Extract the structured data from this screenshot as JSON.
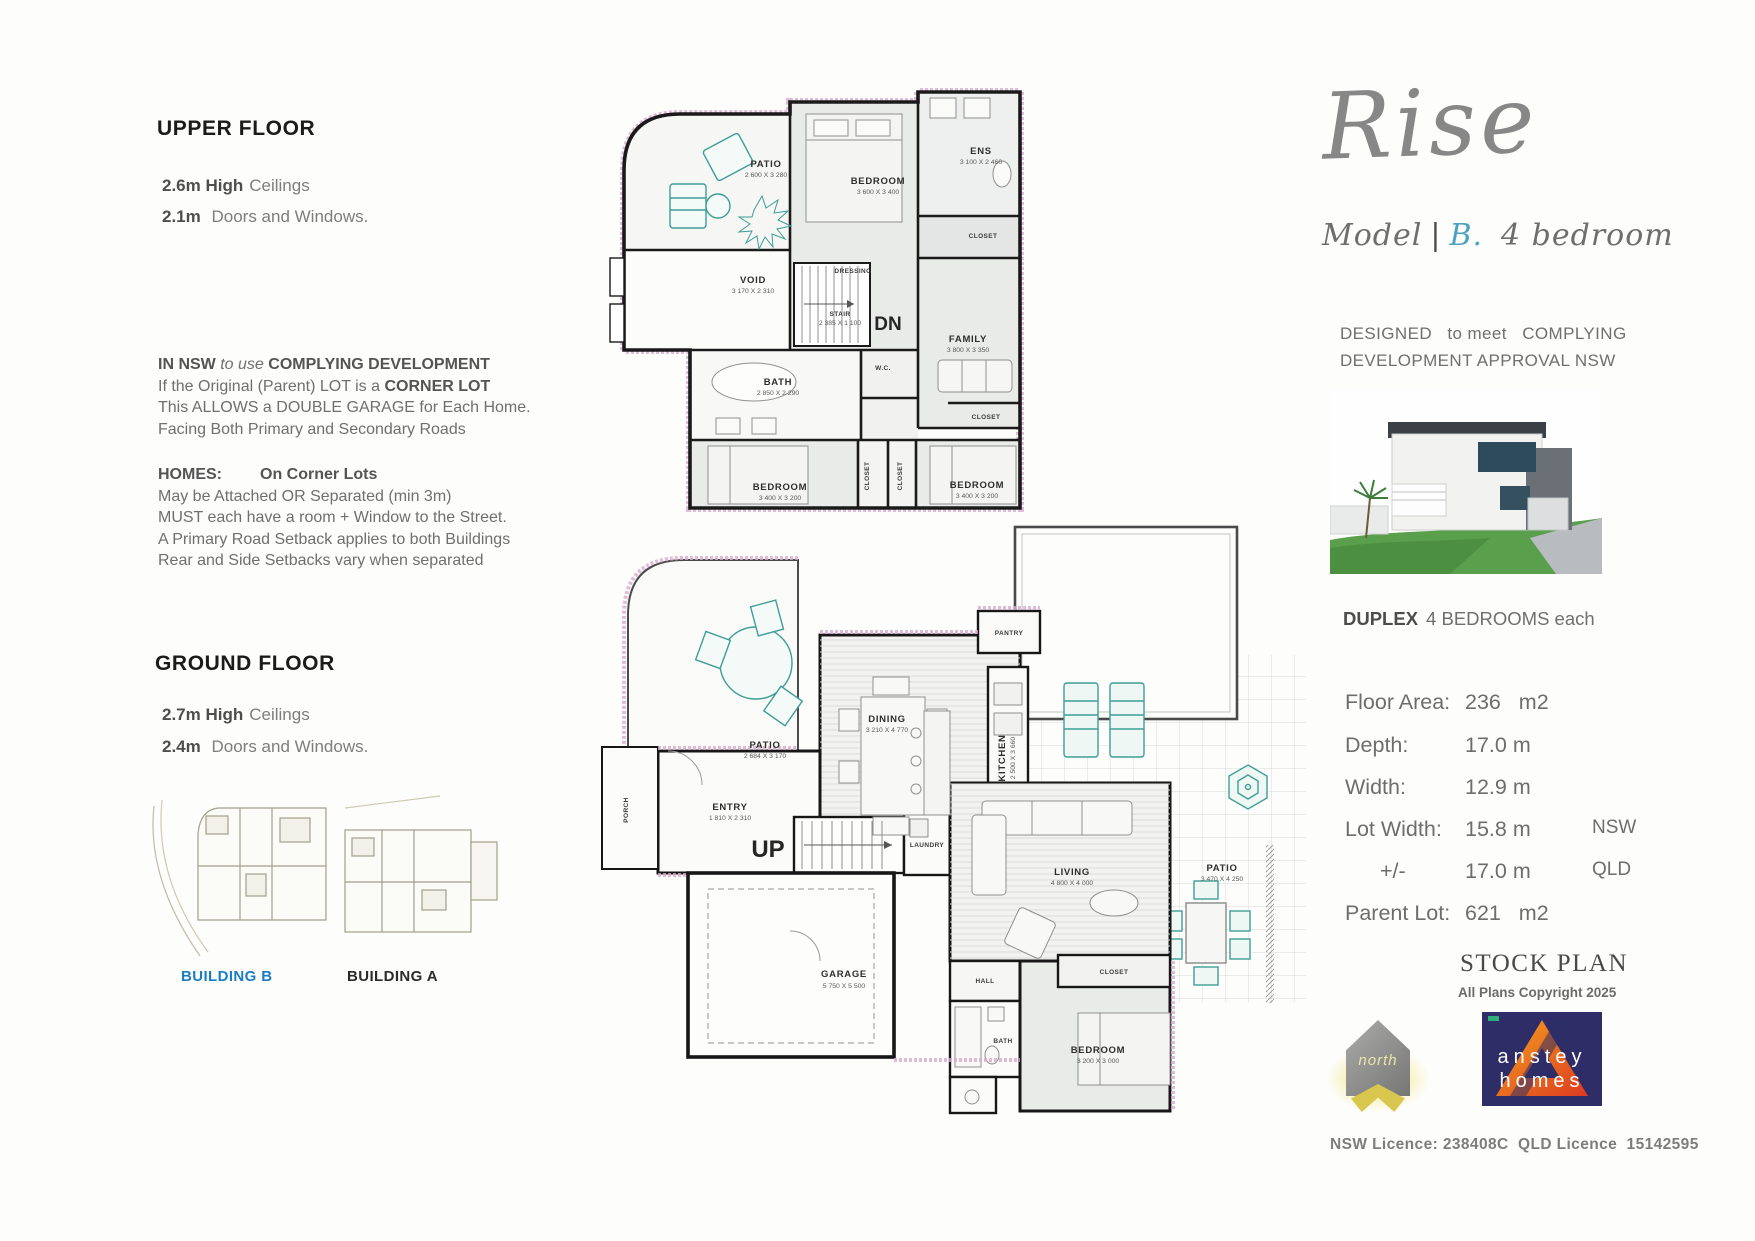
{
  "colors": {
    "building_b_blue": "#1b7dc2",
    "variant_teal": "#4da3bf",
    "plan_accent_pink": "#d9abce",
    "furniture_teal": "#3f9d96",
    "anstey_navy": "#2e2d68",
    "anstey_orange": "#f5a21f",
    "north_gold": "#d9c64e"
  },
  "left_column": {
    "upper_floor": {
      "heading": "UPPER FLOOR",
      "lines": [
        {
          "bold": "2.6m High",
          "rest": "Ceilings"
        },
        {
          "bold": "2.1m",
          "rest": " Doors and Windows."
        }
      ]
    },
    "nsw_note": {
      "l1a": "IN NSW",
      "l1b": " to use ",
      "l1c": "COMPLYING DEVELOPMENT",
      "l2a": "If the Original (Parent) LOT is a ",
      "l2b": "CORNER LOT",
      "l3": "This ALLOWS a DOUBLE GARAGE for Each Home.",
      "l4": "Facing Both Primary and Secondary Roads"
    },
    "homes_note": {
      "h1a": "HOMES:",
      "h1b": "On Corner Lots",
      "h2": "May be Attached OR Separated (min 3m)",
      "h3": "MUST each have a room + Window to the Street.",
      "h4": "A Primary Road Setback applies to both Buildings",
      "h5": "Rear and Side Setbacks vary when separated"
    },
    "ground_floor": {
      "heading": "GROUND FLOOR",
      "lines": [
        {
          "bold": "2.7m High",
          "rest": "Ceilings"
        },
        {
          "bold": "2.4m",
          "rest": " Doors and Windows."
        }
      ]
    },
    "site_plan": {
      "building_b": "BUILDING B",
      "building_a": "BUILDING A"
    }
  },
  "upper_plan": {
    "rooms": {
      "patio": {
        "name": "PATIO",
        "dims": "2 600 X 3 280"
      },
      "bedroom_master": {
        "name": "BEDROOM",
        "dims": "3 600 X 3 400"
      },
      "ens": {
        "name": "ENS",
        "dims": "3 100 X 2 460"
      },
      "closet_master": {
        "name": "CLOSET"
      },
      "dressing": {
        "name": "DRESSING"
      },
      "void": {
        "name": "VOID",
        "dims": "3 170 X 2 310"
      },
      "stair": {
        "name": "STAIR",
        "dims": "2 385 X 1 100",
        "direction": "DN"
      },
      "bath": {
        "name": "BATH",
        "dims": "2 850 X 2 290"
      },
      "wc": {
        "name": "W.C."
      },
      "family": {
        "name": "FAMILY",
        "dims": "3 800 X 3 350"
      },
      "closet_hall": {
        "name": "CLOSET"
      },
      "bedroom_left": {
        "name": "BEDROOM",
        "dims": "3 400 X 3 200"
      },
      "bedroom_right": {
        "name": "BEDROOM",
        "dims": "3 400 X 3 200"
      },
      "closet_mid_a": {
        "name": "CLOSET"
      },
      "closet_mid_b": {
        "name": "CLOSET"
      }
    }
  },
  "ground_plan": {
    "rooms": {
      "patio_front": {
        "name": "PATIO",
        "dims": "2 684 X 3 170"
      },
      "dining": {
        "name": "DINING",
        "dims": "3 210 X 4 770"
      },
      "pantry": {
        "name": "PANTRY"
      },
      "kitchen": {
        "name": "KITCHEN",
        "dims": "2 500 X 3 660"
      },
      "entry": {
        "name": "ENTRY",
        "dims": "1 810 X 2 310"
      },
      "porch": {
        "name": "PORCH"
      },
      "stair": {
        "direction": "UP"
      },
      "laundry": {
        "name": "LAUNDRY"
      },
      "living": {
        "name": "LIVING",
        "dims": "4 800 X 4 000"
      },
      "patio_rear": {
        "name": "PATIO",
        "dims": "3 470 X 4 250"
      },
      "garage": {
        "name": "GARAGE",
        "dims": "5 750 X 5 500"
      },
      "hall": {
        "name": "HALL"
      },
      "bath": {
        "name": "BATH"
      },
      "closet": {
        "name": "CLOSET"
      },
      "bedroom": {
        "name": "BEDROOM",
        "dims": "3 200 X 3 000"
      }
    }
  },
  "right_column": {
    "brand": "Rise",
    "model": {
      "prefix": "Model",
      "bar": "|",
      "variant": "B.",
      "suffix": "4 bedroom"
    },
    "designed_line1": "DESIGNED   to meet   COMPLYING",
    "designed_line2": "DEVELOPMENT APPROVAL NSW",
    "duplex": {
      "bold": "DUPLEX",
      "rest": "4 BEDROOMS each"
    },
    "specs": [
      {
        "label": "Floor Area:",
        "value": "236   m2",
        "region": ""
      },
      {
        "label": "Depth:",
        "value": "17.0 m",
        "region": ""
      },
      {
        "label": "Width:",
        "value": "12.9 m",
        "region": ""
      },
      {
        "label": "Lot Width:",
        "value": "15.8 m",
        "region": "NSW"
      },
      {
        "label": "+/-",
        "value": "17.0 m",
        "region": "QLD"
      },
      {
        "label": "Parent Lot:",
        "value": "621   m2",
        "region": ""
      }
    ],
    "stock_plan": "STOCK PLAN",
    "copyright": "All Plans Copyright 2025",
    "north_logo_text": "north",
    "anstey_logo": {
      "line1": "anstey",
      "line2": "homes"
    },
    "licence": "NSW Licence: 238408C  QLD Licence  15142595"
  }
}
